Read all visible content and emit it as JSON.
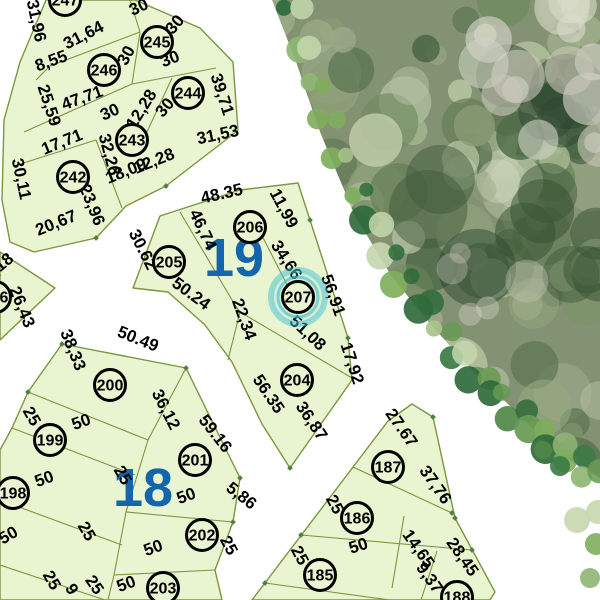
{
  "map": {
    "title": "Cadastral subdivision plan",
    "selected_parcel": "207",
    "colors": {
      "background": "#ffffff",
      "parcel_fill": "#e9f4d1",
      "parcel_line": "#7d953f",
      "circle_stroke": "#000000",
      "label_color": "#000000",
      "block_number_color": "#1565ad",
      "highlight": "#45c2d4",
      "vertex_dot": "#4f8040",
      "tree_base": "#839272"
    },
    "block_numbers": [
      {
        "label": "19",
        "x": 234,
        "y": 276,
        "size": 54
      },
      {
        "label": "18",
        "x": 143,
        "y": 506,
        "size": 54
      }
    ],
    "parcel_markers": [
      {
        "id": "247",
        "x": 65,
        "y": 0
      },
      {
        "id": "246",
        "x": 104,
        "y": 70
      },
      {
        "id": "245",
        "x": 157,
        "y": 42
      },
      {
        "id": "244",
        "x": 188,
        "y": 93
      },
      {
        "id": "243",
        "x": 132,
        "y": 140
      },
      {
        "id": "242",
        "x": 73,
        "y": 177
      },
      {
        "id": "196",
        "x": -5,
        "y": 297
      },
      {
        "id": "205",
        "x": 169,
        "y": 262
      },
      {
        "id": "206",
        "x": 250,
        "y": 227
      },
      {
        "id": "207",
        "x": 298,
        "y": 297,
        "highlighted": true
      },
      {
        "id": "204",
        "x": 297,
        "y": 380
      },
      {
        "id": "200",
        "x": 110,
        "y": 385
      },
      {
        "id": "199",
        "x": 50,
        "y": 440
      },
      {
        "id": "198",
        "x": 13,
        "y": 493
      },
      {
        "id": "201",
        "x": 195,
        "y": 460
      },
      {
        "id": "202",
        "x": 202,
        "y": 535
      },
      {
        "id": "203",
        "x": 163,
        "y": 588
      },
      {
        "id": "187",
        "x": 388,
        "y": 467
      },
      {
        "id": "186",
        "x": 357,
        "y": 518
      },
      {
        "id": "185",
        "x": 320,
        "y": 575
      },
      {
        "id": "188",
        "x": 457,
        "y": 597
      }
    ],
    "dimension_labels": [
      {
        "t": "31,96",
        "x": 31,
        "y": 22,
        "r": 78
      },
      {
        "t": "31,64",
        "x": 86,
        "y": 40,
        "r": -27
      },
      {
        "t": "8,55",
        "x": 53,
        "y": 66,
        "r": -20
      },
      {
        "t": "30",
        "x": 141,
        "y": 12,
        "r": -25
      },
      {
        "t": "30",
        "x": 179,
        "y": 28,
        "r": -50
      },
      {
        "t": "30",
        "x": 131,
        "y": 58,
        "r": -62
      },
      {
        "t": "30",
        "x": 172,
        "y": 64,
        "r": -22
      },
      {
        "t": "25,59",
        "x": 44,
        "y": 107,
        "r": 72
      },
      {
        "t": "47,71",
        "x": 84,
        "y": 103,
        "r": -20
      },
      {
        "t": "30",
        "x": 112,
        "y": 117,
        "r": -24
      },
      {
        "t": "12,28",
        "x": 146,
        "y": 112,
        "r": -58
      },
      {
        "t": "30",
        "x": 169,
        "y": 111,
        "r": -50
      },
      {
        "t": "39,71",
        "x": 217,
        "y": 96,
        "r": 72
      },
      {
        "t": "31,53",
        "x": 219,
        "y": 140,
        "r": -12
      },
      {
        "t": "17,71",
        "x": 64,
        "y": 147,
        "r": -22
      },
      {
        "t": "32,26",
        "x": 104,
        "y": 156,
        "r": 75
      },
      {
        "t": "30,11",
        "x": 16,
        "y": 180,
        "r": 78
      },
      {
        "t": "18,09",
        "x": 128,
        "y": 176,
        "r": -22
      },
      {
        "t": "12,28",
        "x": 156,
        "y": 166,
        "r": -22
      },
      {
        "t": "20,67",
        "x": 58,
        "y": 228,
        "r": -22
      },
      {
        "t": "23,96",
        "x": 87,
        "y": 207,
        "r": 68
      },
      {
        "t": "9,18",
        "x": 2,
        "y": 271,
        "r": -40
      },
      {
        "t": "26,43",
        "x": 17,
        "y": 309,
        "r": 68
      },
      {
        "t": "48.35",
        "x": 223,
        "y": 199,
        "r": -13
      },
      {
        "t": "11,99",
        "x": 279,
        "y": 211,
        "r": 62
      },
      {
        "t": "46,74",
        "x": 198,
        "y": 232,
        "r": 65
      },
      {
        "t": "30.62",
        "x": 138,
        "y": 252,
        "r": 63
      },
      {
        "t": "34,66",
        "x": 282,
        "y": 263,
        "r": 57
      },
      {
        "t": "56,91",
        "x": 328,
        "y": 297,
        "r": 70
      },
      {
        "t": "50.24",
        "x": 188,
        "y": 298,
        "r": 36
      },
      {
        "t": "22,34",
        "x": 239,
        "y": 321,
        "r": 70
      },
      {
        "t": "51,08",
        "x": 304,
        "y": 337,
        "r": 43
      },
      {
        "t": "17,92",
        "x": 347,
        "y": 365,
        "r": 72
      },
      {
        "t": "56.35",
        "x": 264,
        "y": 397,
        "r": 56
      },
      {
        "t": "36,87",
        "x": 307,
        "y": 424,
        "r": 56
      },
      {
        "t": "38,33",
        "x": 68,
        "y": 352,
        "r": 68
      },
      {
        "t": "50.49",
        "x": 136,
        "y": 344,
        "r": 22
      },
      {
        "t": "36,12",
        "x": 161,
        "y": 412,
        "r": 63
      },
      {
        "t": "25",
        "x": 27,
        "y": 419,
        "r": 60
      },
      {
        "t": "50",
        "x": 83,
        "y": 427,
        "r": -20
      },
      {
        "t": "59.16",
        "x": 211,
        "y": 437,
        "r": 52
      },
      {
        "t": "25",
        "x": 118,
        "y": 478,
        "r": 60
      },
      {
        "t": "50",
        "x": 46,
        "y": 484,
        "r": -20
      },
      {
        "t": "5,86",
        "x": 238,
        "y": 500,
        "r": 38
      },
      {
        "t": "50",
        "x": 188,
        "y": 501,
        "r": -20
      },
      {
        "t": "25",
        "x": 224,
        "y": 548,
        "r": 62
      },
      {
        "t": "25",
        "x": 82,
        "y": 534,
        "r": 60
      },
      {
        "t": "50",
        "x": 155,
        "y": 553,
        "r": -20
      },
      {
        "t": "50",
        "x": 11,
        "y": 540,
        "r": -30
      },
      {
        "t": "25",
        "x": 47,
        "y": 583,
        "r": 60
      },
      {
        "t": "9",
        "x": 67,
        "y": 592,
        "r": 60
      },
      {
        "t": "25",
        "x": 90,
        "y": 588,
        "r": 55
      },
      {
        "t": "50",
        "x": 128,
        "y": 589,
        "r": -20
      },
      {
        "t": "27.67",
        "x": 397,
        "y": 431,
        "r": 55
      },
      {
        "t": "37,76",
        "x": 431,
        "y": 488,
        "r": 55
      },
      {
        "t": "25",
        "x": 330,
        "y": 507,
        "r": 62
      },
      {
        "t": "50",
        "x": 360,
        "y": 551,
        "r": -18
      },
      {
        "t": "25",
        "x": 295,
        "y": 558,
        "r": 62
      },
      {
        "t": "14,65",
        "x": 414,
        "y": 552,
        "r": 55
      },
      {
        "t": "9,37",
        "x": 425,
        "y": 581,
        "r": 55
      },
      {
        "t": "28,45",
        "x": 458,
        "y": 560,
        "r": 55
      }
    ]
  }
}
